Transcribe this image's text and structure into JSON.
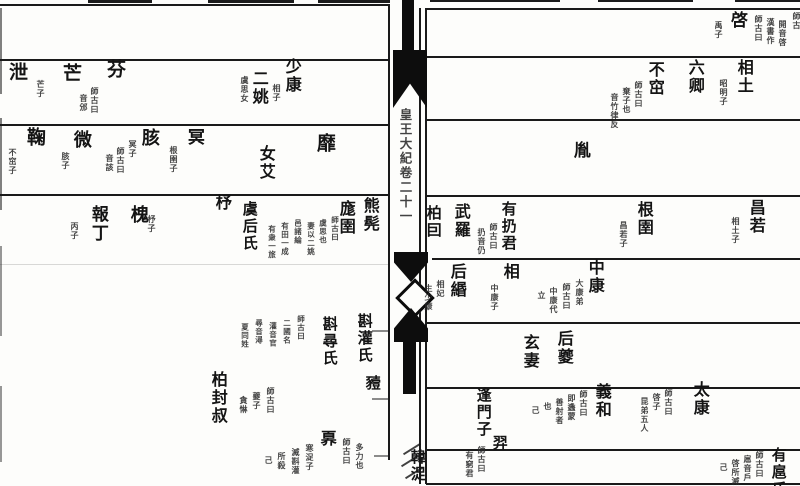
{
  "fold": {
    "title": "皇王大紀卷二十一"
  },
  "left_page": {
    "row2": {
      "xie": "泄",
      "xie_note": "芒子",
      "mang": "芒",
      "fen": "芬",
      "fen_notes": [
        "師古曰",
        "音邠"
      ],
      "eryao": "二姚",
      "eryao_note": "虞思女",
      "shaokang": "少康",
      "shaokang_note": "相子"
    },
    "row3": {
      "ju": "鞠",
      "ju_note": "不窋子",
      "wei": "微",
      "wei_note": "胲子",
      "hai": "胲",
      "hai_notes": [
        "冥子",
        "師古曰",
        "音該"
      ],
      "ming": "冥",
      "ming_note": "根圉子",
      "nuai": "女艾",
      "mi": "靡"
    },
    "row4": {
      "baoding": "報丁",
      "baoding_note": "丙子",
      "huai": "槐",
      "huai_note": "杼子",
      "zhu": "杼",
      "yuhoushi": "虞后氏",
      "yu_notes": [
        "師古曰",
        "虞思也",
        "妻以二姚",
        "邑諸綸",
        "有田一成",
        "有衆一旅"
      ],
      "mangyu": "庬圉",
      "xiongkun": "熊髡"
    },
    "bottom": {
      "zhenguan": "斟灌氏",
      "yi": "豷",
      "zhenxun": "斟尋氏",
      "zhen_notes": [
        "師古曰",
        "二國名",
        "灌音官",
        "尋音潯",
        "夏同姓"
      ],
      "bofengshu": "柏封叔",
      "bo_notes": [
        "師古曰",
        "夔子",
        "貪惏"
      ],
      "ao": "奡",
      "ao_notes_r": [
        "師古曰",
        "多力也"
      ],
      "ao_notes_l": [
        "寒浞子",
        "滅斟灌",
        "所殺",
        "己"
      ]
    }
  },
  "right_page": {
    "row1": {
      "qi": "啓",
      "qi_note": "禹子",
      "qi_notes": [
        "師古曰",
        "漢書作",
        "開音啓"
      ],
      "edge": "師古"
    },
    "row2": {
      "xiangtu": "相土",
      "xiangtu_note": "昭明子",
      "liuqing": "六卿",
      "buzhu": "不窋",
      "buzhu_notes": [
        "師古曰",
        "棄子也",
        "音竹律反"
      ]
    },
    "row3": {
      "yin": "胤"
    },
    "row4": {
      "boyin": "柏囙",
      "wuluo": "武羅",
      "reng_notes": [
        "師古曰",
        "扔音仍"
      ],
      "yourengjun": "有扔君",
      "genyu": "根圉",
      "genyu_note": "昌若子",
      "changruo": "昌若",
      "changruo_note": "相土子"
    },
    "row5": {
      "houmin": "后緡",
      "houmin_notes": [
        "相妃",
        "生少康"
      ],
      "xiang": "相",
      "xiang_note": "中康子",
      "zhongkang_notes": [
        "大康弟",
        "師古曰",
        "中康代",
        "立"
      ],
      "zhongkang": "中康"
    },
    "row6": {
      "xuanqi": "玄妻",
      "houkui": "后夔"
    },
    "row7": {
      "pangmenzi": "逢門子",
      "pang_notes": [
        "師古曰",
        "即蠭蒙",
        "善射者",
        "也",
        "己"
      ],
      "xihe": "義和",
      "taikang_notes": [
        "師古曰",
        "啓子",
        "昆弟五人"
      ],
      "taikang": "太康"
    },
    "row8": {
      "hanzhuo": "韓浞",
      "yi": "羿",
      "yi_notes": [
        "師古曰",
        "有窮君"
      ],
      "youhushi": "有扈氏",
      "youhu_notes": [
        "師古曰",
        "扈音戶",
        "啓所滅",
        "己"
      ]
    }
  }
}
